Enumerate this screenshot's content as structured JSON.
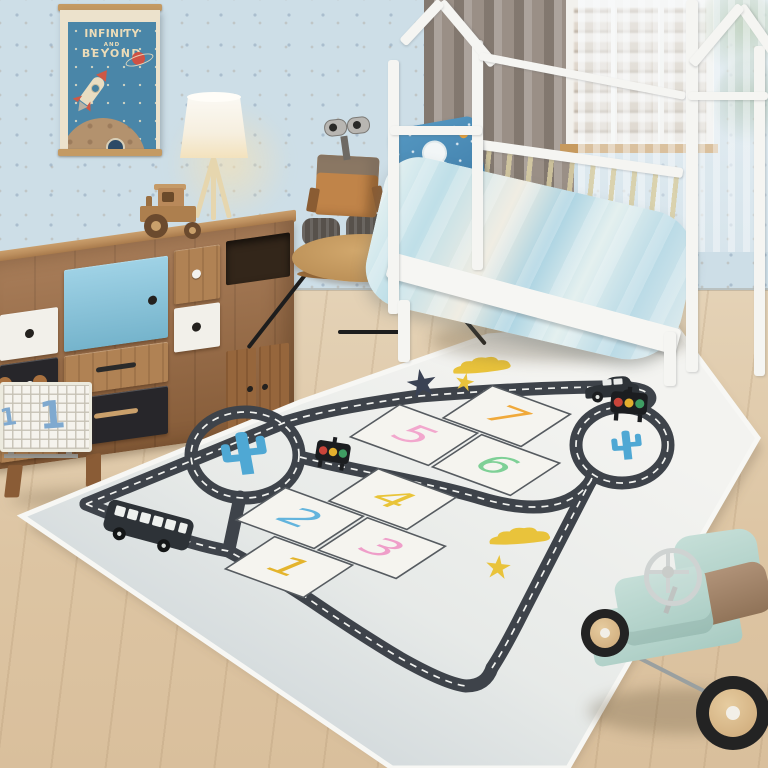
{
  "poster": {
    "lines": [
      "INFINITY",
      "AND",
      "BEYOND"
    ],
    "bg_color": "#4a86a8",
    "text_color": "#ecdcb8",
    "planet_color": "#cf5143"
  },
  "storage_basket": {
    "number": "1",
    "number_color": "#7fa9cf"
  },
  "rug": {
    "numbers": [
      {
        "label": "1",
        "color": "#e4b42c"
      },
      {
        "label": "2",
        "color": "#62b4dd"
      },
      {
        "label": "3",
        "color": "#ef9ec9"
      },
      {
        "label": "4",
        "color": "#e9c438"
      },
      {
        "label": "5",
        "color": "#f2a7cd"
      },
      {
        "label": "6",
        "color": "#7ed096"
      },
      {
        "label": "7",
        "color": "#f0a93a"
      }
    ],
    "road_color": "#3e434a",
    "dash_color": "#f2f3f0",
    "square_fill": "#f5f4ef",
    "cactus_color": "#4fa8d4",
    "traffic_light_colors": [
      "#c9443a",
      "#e3af2e",
      "#3f9d63"
    ],
    "star_navy": "#3a4254",
    "star_yellow": "#e9c33b",
    "cloud_yellow": "#e9c33b",
    "vehicle_color": "#2d3237",
    "star_glyph": "★"
  },
  "palette": {
    "wall": "#cddee7",
    "floor": "#e0cbab",
    "curtain": "#9a8f86",
    "bed_frame": "#f5f5f2",
    "duvet_blue": "#b9dae6",
    "pillow_blue": "#4d90ba",
    "dresser_wood": "#9c6b42",
    "dresser_blue_door": "#7fc3dd",
    "drawer_black": "#27262a",
    "drawer_white": "#f2f0ea",
    "table_wood": "#c79a62",
    "lamp_shade": "#f7f2e6",
    "robot_body": "#c08449",
    "toy_car_mint": "#b7d6ce",
    "toy_car_seat": "#9b7d61",
    "wheel_wood": "#d9b98c"
  }
}
